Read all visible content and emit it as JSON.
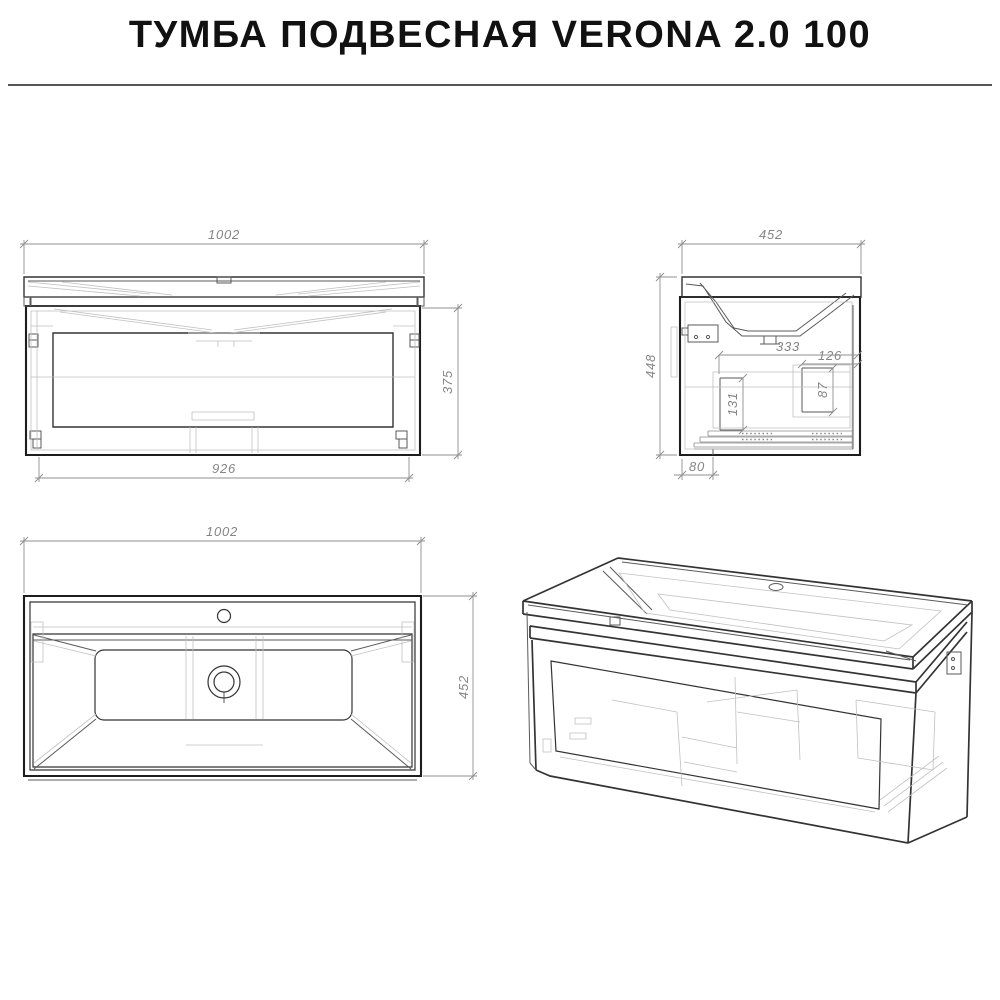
{
  "header": {
    "title": "ТУМБА ПОДВЕСНАЯ VERONA 2.0 100"
  },
  "colors": {
    "line_main": "#1d1d1d",
    "line_medium": "#333333",
    "line_thin": "#5a5a5a",
    "line_faint": "#c0c0c0",
    "rail_gray": "#8a8a8a",
    "dim_line": "#8f8f8f",
    "dim_text": "#858585",
    "title_text": "#111111",
    "divider": "#555555",
    "background": "#ffffff"
  },
  "views": {
    "front": {
      "dims": {
        "width_top": "1002",
        "height_right": "375",
        "width_bottom": "926"
      }
    },
    "side": {
      "dims": {
        "width_top": "452",
        "height_left": "448",
        "inner_width": "333",
        "inner_width_small": "126",
        "inner_height": "131",
        "inner_height_small": "87",
        "bottom_offset": "80"
      }
    },
    "top": {
      "dims": {
        "width_top": "1002",
        "depth_right": "452"
      }
    }
  }
}
